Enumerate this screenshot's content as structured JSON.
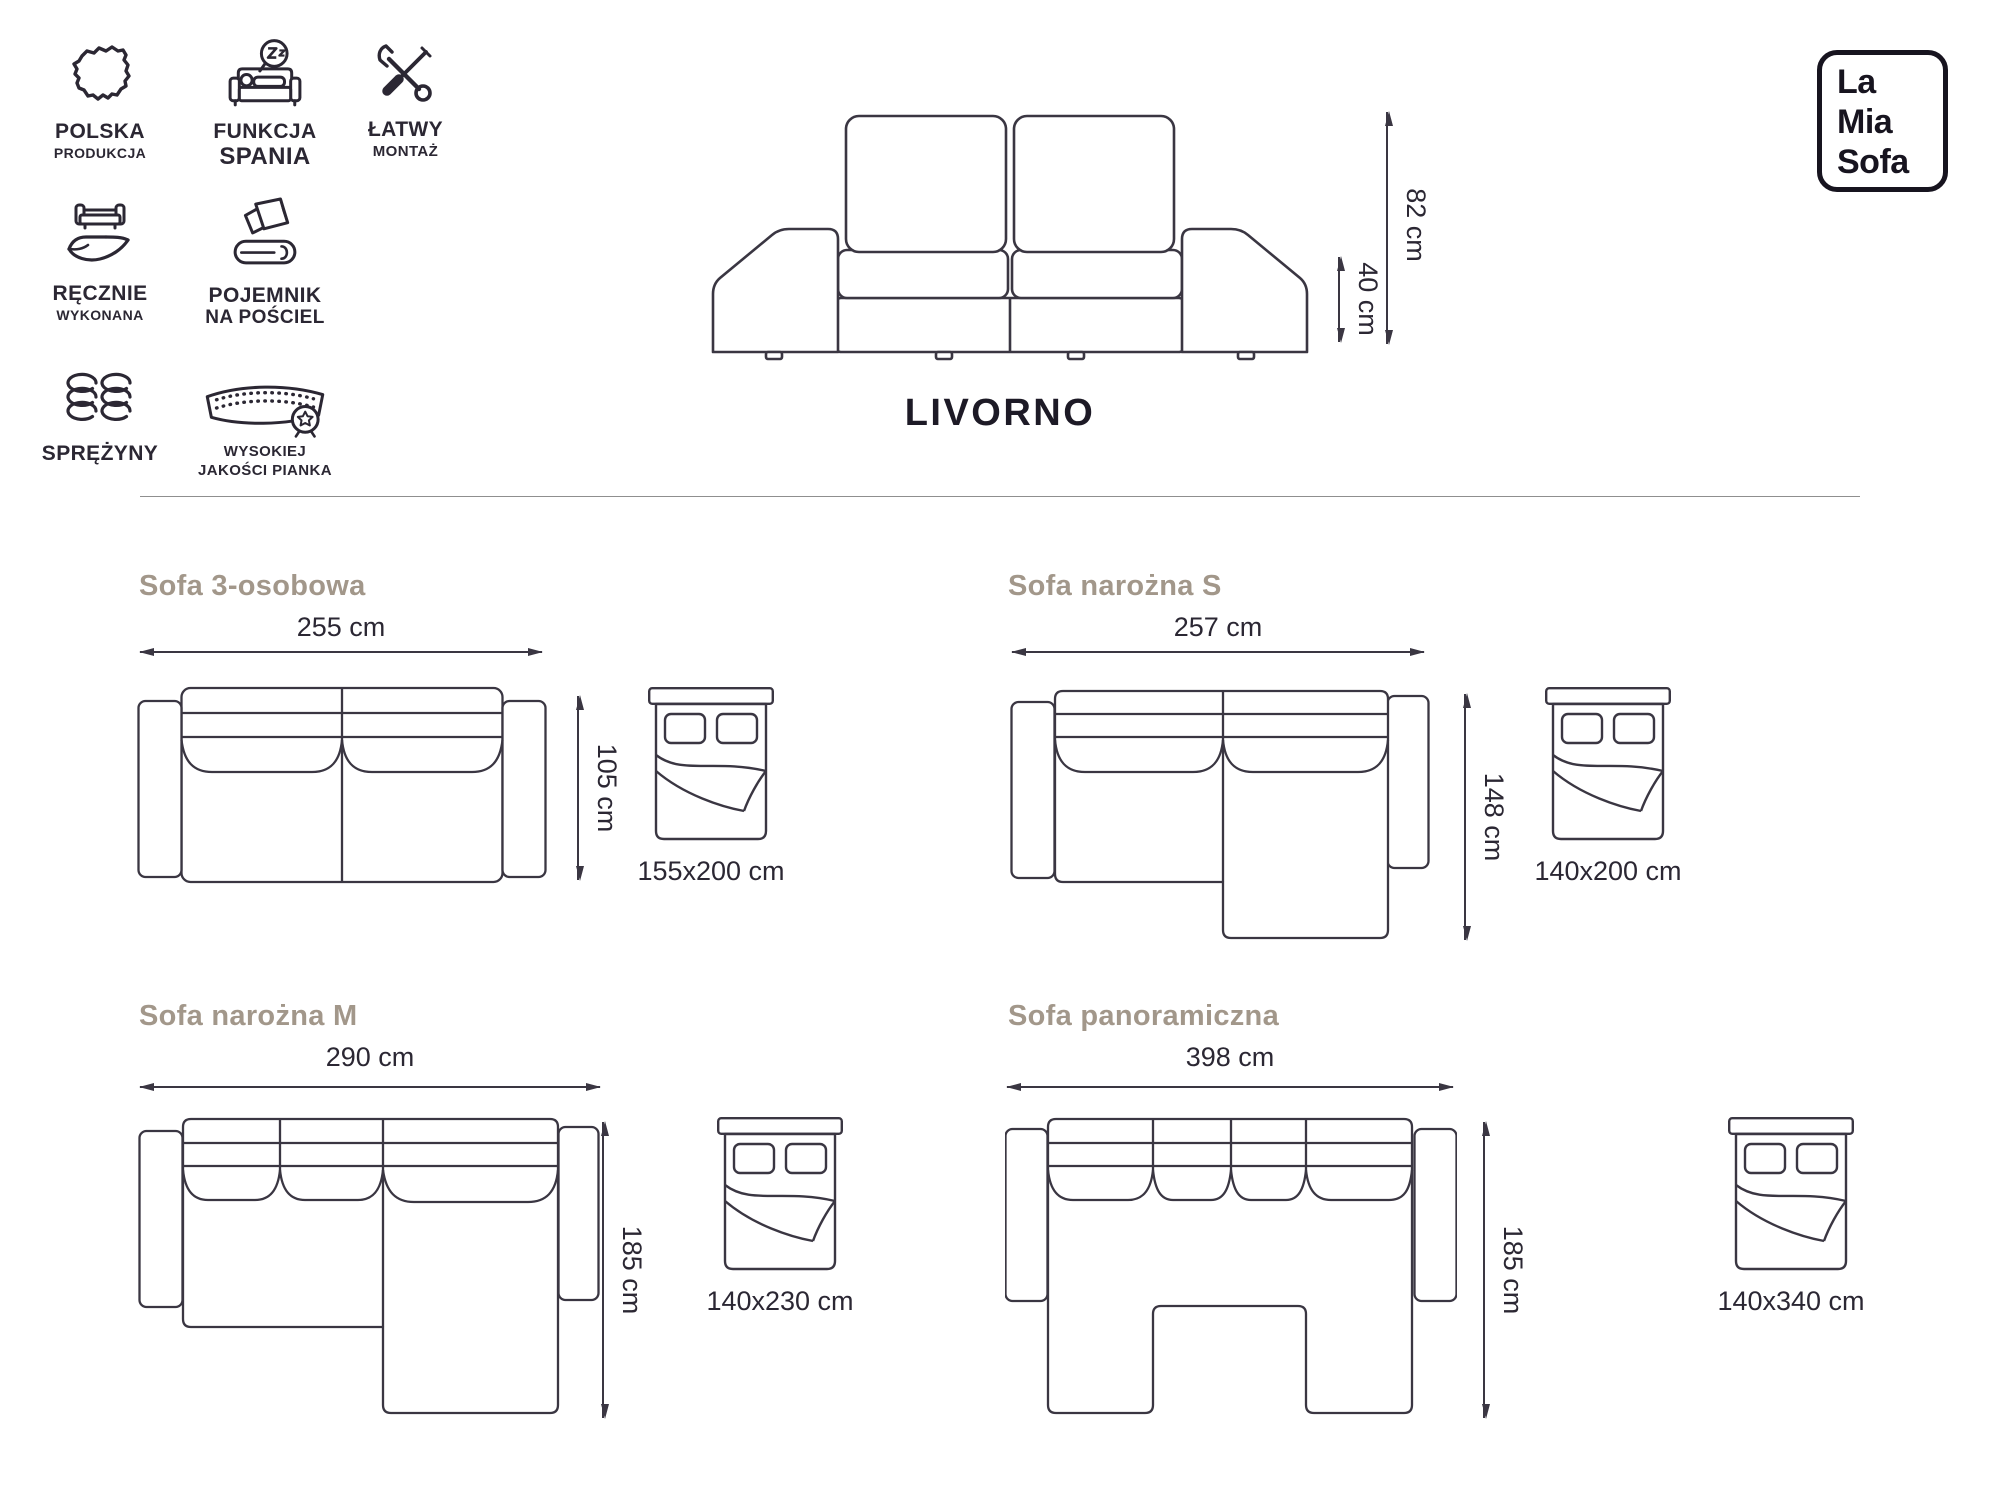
{
  "brand": {
    "logo_lines": [
      "La",
      "Mia",
      "Sofa"
    ]
  },
  "product": {
    "name": "LIVORNO",
    "overall_height": "82 cm",
    "seat_height": "40 cm"
  },
  "features": [
    {
      "icon": "poland-map-icon",
      "lines": [
        "POLSKA",
        "PRODUKCJA"
      ]
    },
    {
      "icon": "sleep-function-icon",
      "lines": [
        "FUNKCJA",
        "SPANIA"
      ]
    },
    {
      "icon": "easy-assembly-icon",
      "lines": [
        "ŁATWY",
        "MONTAŻ"
      ]
    },
    {
      "icon": "handmade-icon",
      "lines": [
        "RĘCZNIE",
        "WYKONANA"
      ]
    },
    {
      "icon": "bedding-storage-icon",
      "lines": [
        "POJEMNIK",
        "NA POŚCIEL"
      ]
    },
    {
      "icon": "springs-icon",
      "lines": [
        "SPRĘŻYNY"
      ]
    },
    {
      "icon": "foam-quality-icon",
      "lines": [
        "WYSOKIEJ",
        "JAKOŚCI PIANKA"
      ]
    }
  ],
  "variants": [
    {
      "title": "Sofa 3-osobowa",
      "width": "255 cm",
      "depth": "105 cm",
      "bed_size": "155x200 cm"
    },
    {
      "title": "Sofa narożna S",
      "width": "257 cm",
      "depth": "148 cm",
      "bed_size": "140x200 cm"
    },
    {
      "title": "Sofa narożna M",
      "width": "290 cm",
      "depth": "185 cm",
      "bed_size": "140x230 cm"
    },
    {
      "title": "Sofa panoramiczna",
      "width": "398 cm",
      "depth": "185 cm",
      "bed_size": "140x340 cm"
    }
  ],
  "colors": {
    "ink": "#2b2733",
    "heading": "#a2978a",
    "logo": "#17141f"
  }
}
